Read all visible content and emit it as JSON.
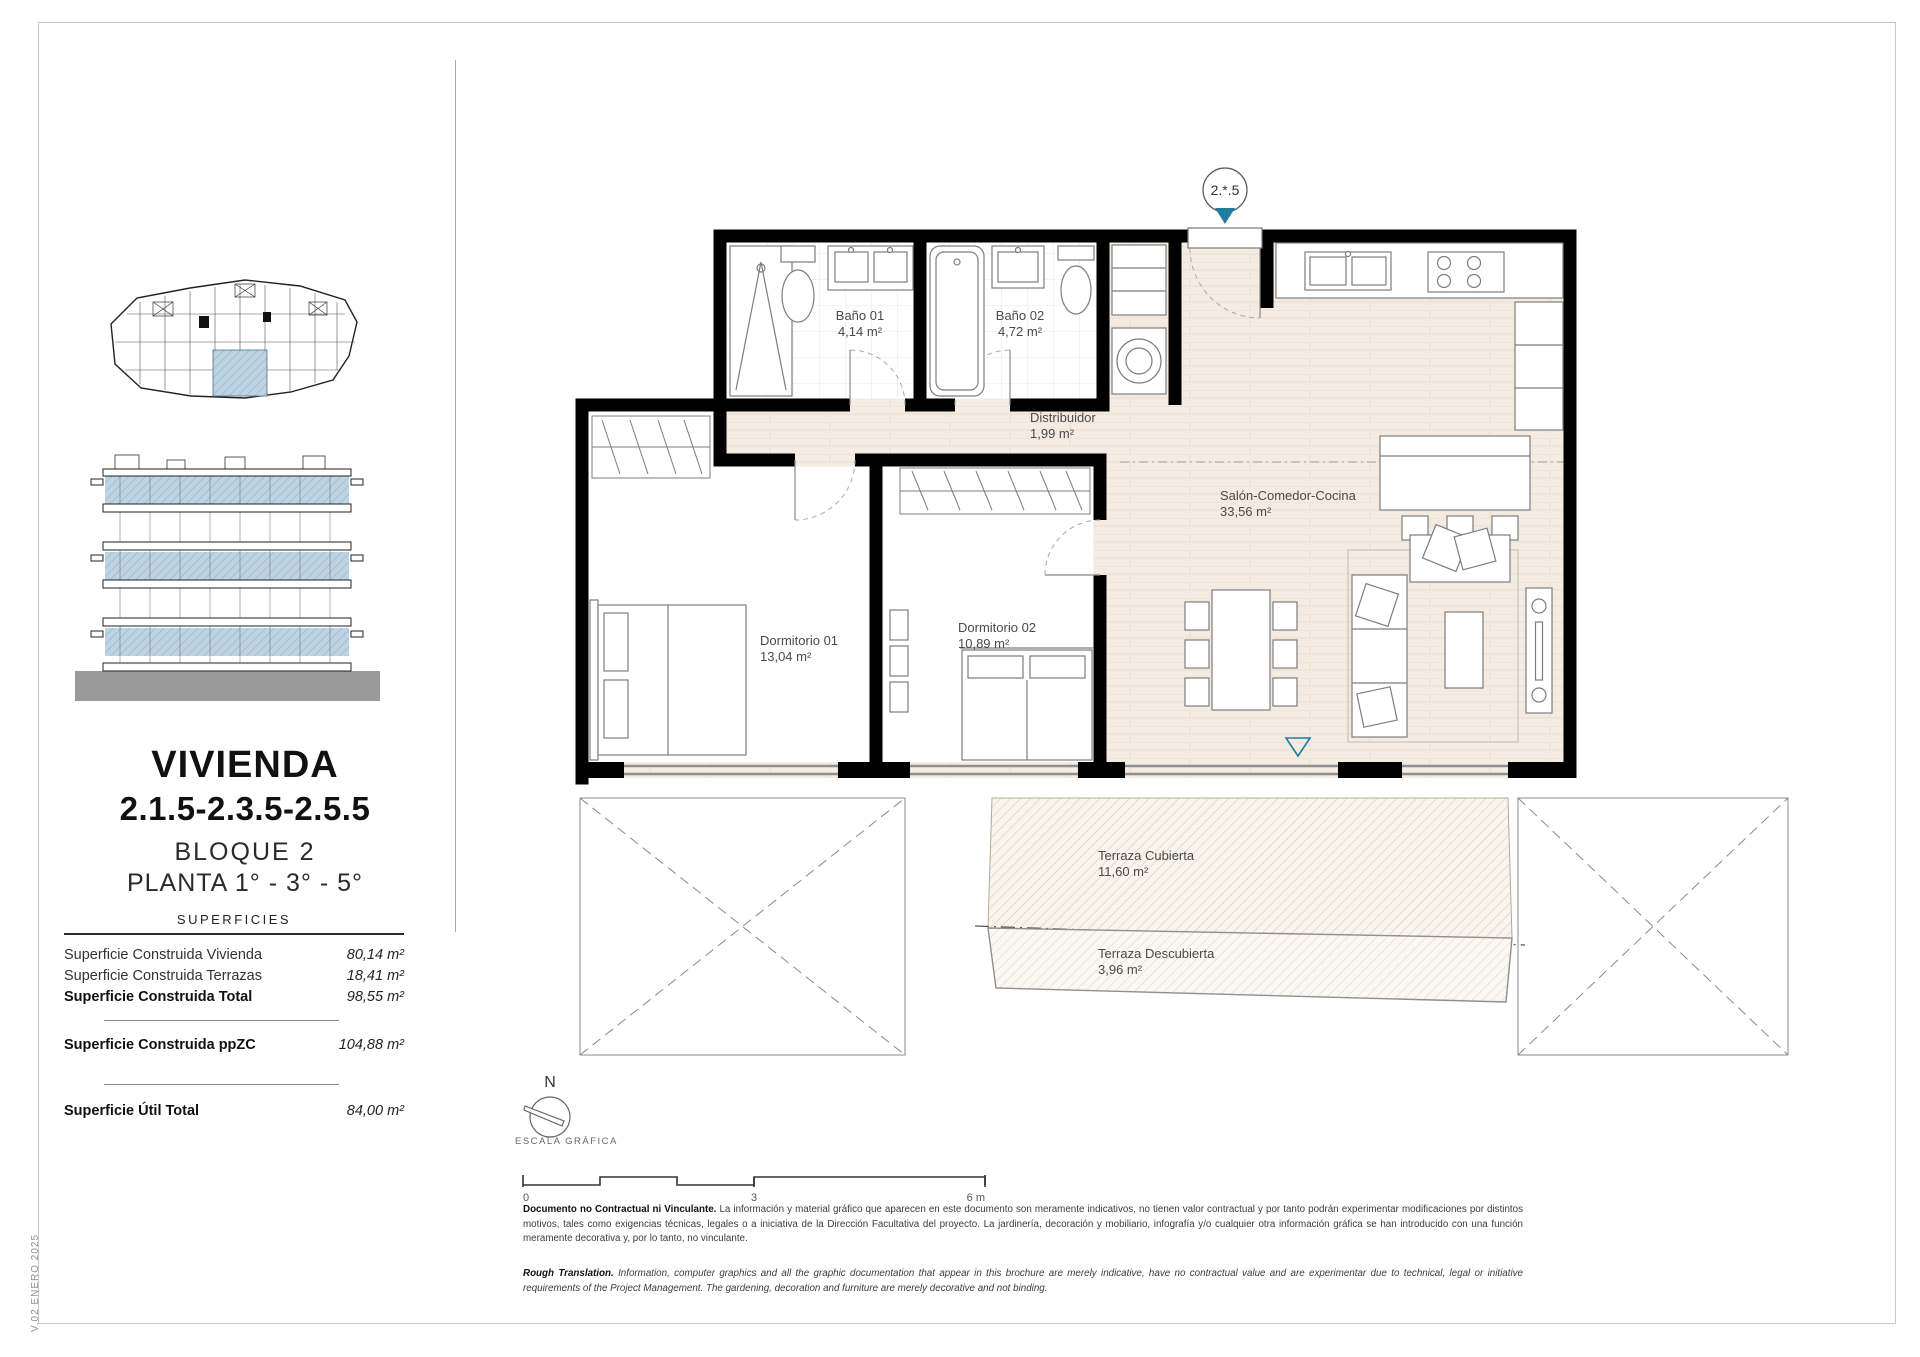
{
  "sidebar": {
    "title_line1": "VIVIENDA",
    "title_line2": "2.1.5-2.3.5-2.5.5",
    "subtitle_line1": "BLOQUE 2",
    "subtitle_line2": "PLANTA 1° - 3° - 5°",
    "surfaces": {
      "heading": "SUPERFICIES",
      "rows": [
        {
          "label": "Superficie Construida Vivienda",
          "value": "80,14 m²"
        },
        {
          "label": "Superficie Construida Terrazas",
          "value": "18,41 m²"
        },
        {
          "label": "Superficie Construida Total",
          "value": "98,55 m²"
        },
        {
          "label": "Superficie Construida ppZC",
          "value": "104,88 m²"
        },
        {
          "label": "Superficie Útil Total",
          "value": "84,00 m²"
        }
      ]
    }
  },
  "plan": {
    "unit_marker": "2.*.5",
    "rooms": [
      {
        "name": "Baño 01",
        "area": "4,14 m²"
      },
      {
        "name": "Baño 02",
        "area": "4,72 m²"
      },
      {
        "name": "Distribuidor",
        "area": "1,99 m²"
      },
      {
        "name": "Salón-Comedor-Cocina",
        "area": "33,56 m²"
      },
      {
        "name": "Dormitorio 01",
        "area": "13,04 m²"
      },
      {
        "name": "Dormitorio 02",
        "area": "10,89 m²"
      },
      {
        "name": "Terraza Cubierta",
        "area": "11,60 m²"
      },
      {
        "name": "Terraza Descubierta",
        "area": "3,96 m²"
      }
    ],
    "colors": {
      "accent_teal": "#1f7e9f",
      "highlight_blue": "#bfd4e2",
      "floor_cream": "#f4ece2",
      "wall_black": "#000000"
    }
  },
  "legend": {
    "north_label": "N",
    "scale_label": "ESCALA GRÁFICA",
    "scale_ticks": [
      "0",
      "3",
      "6 m"
    ]
  },
  "disclaimer": {
    "es_lead": "Documento no Contractual ni Vinculante.",
    "es_body": " La información y material gráfico que aparecen en este documento son meramente indicativos, no tienen valor contractual y por tanto podrán experimentar modificaciones por distintos motivos, tales como exigencias técnicas, legales o a iniciativa de la Dirección Facultativa del proyecto. La jardinería, decoración y mobiliario, infografía y/o cualquier otra información gráfica se han introducido con una función meramente decorativa y, por lo tanto, no vinculante.",
    "en_lead": "Rough Translation.",
    "en_body": " Information, computer graphics and all the graphic documentation that appear in this brochure are merely indicative, have no contractual value and are experimentar due to technical, legal or initiative requirements of the Project Management. The gardening, decoration and furniture are merely decorative and not binding."
  },
  "footer": {
    "version_note": "V.02 ENERO 2025"
  }
}
